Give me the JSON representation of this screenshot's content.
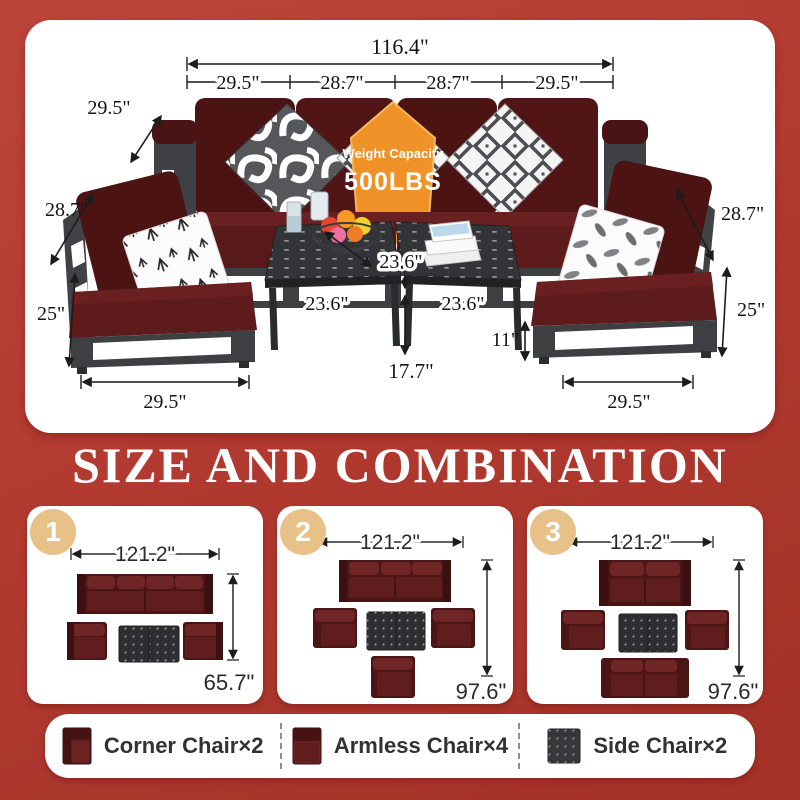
{
  "scene": {
    "badge": {
      "line1": "Weight Capacity",
      "line2": "500LBS"
    },
    "dims": {
      "total_width": "116.4\"",
      "seat1": "29.5\"",
      "seat2": "28.7\"",
      "seat3": "28.7\"",
      "seat4": "29.5\"",
      "sofa_depth": "29.5\"",
      "back_height_left": "28.7\"",
      "seat_height_left": "25\"",
      "chair_width_left": "29.5\"",
      "table_depth": "23.6\"",
      "table_width_left": "23.6\"",
      "table_width_right": "23.6\"",
      "table_height": "17.7\"",
      "frame_height": "11\"",
      "back_height_right": "28.7\"",
      "seat_height_right": "25\"",
      "chair_width_right": "29.5\""
    }
  },
  "heading": "SIZE AND COMBINATION",
  "combos": [
    {
      "number": "1",
      "width": "121.2\"",
      "depth": "65.7\""
    },
    {
      "number": "2",
      "width": "121.2\"",
      "depth": "97.6\""
    },
    {
      "number": "3",
      "width": "121.2\"",
      "depth": "97.6\""
    }
  ],
  "legend": {
    "items": [
      {
        "icon": "corner-chair-icon",
        "label": "Corner Chair×2"
      },
      {
        "icon": "armless-chair-icon",
        "label": "Armless Chair×4"
      },
      {
        "icon": "side-chair-icon",
        "label": "Side Chair×2"
      }
    ]
  },
  "colors": {
    "background_red": "#b23a30",
    "badge_orange": "#ef9227",
    "cushion_red": "#4c1313",
    "frame_gray": "#3d3f42",
    "number_gold": "#e7c188"
  }
}
